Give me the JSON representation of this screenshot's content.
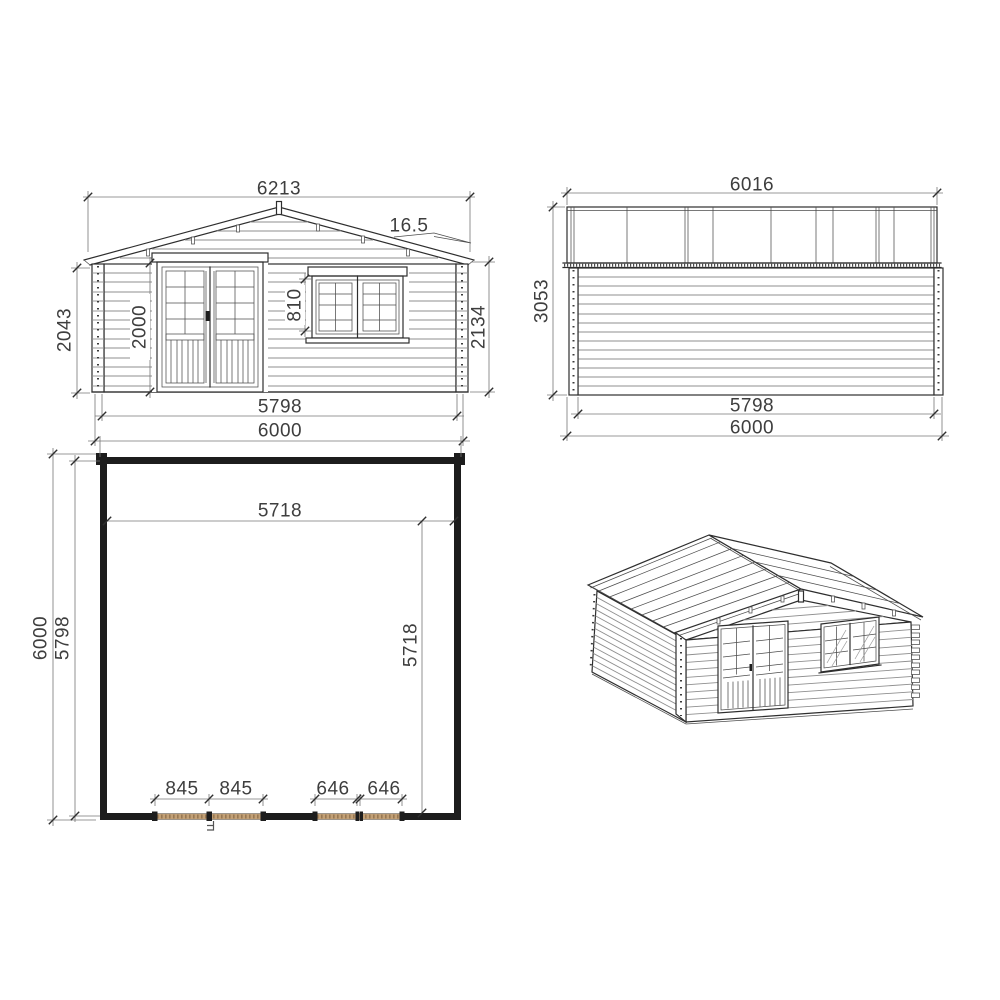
{
  "front_elevation": {
    "roof_width": "6213",
    "roof_angle": "16.5",
    "left_height": "2043",
    "door_height": "2000",
    "window_height": "810",
    "right_height": "2134",
    "wall_width": "5798",
    "overall_width": "6000"
  },
  "side_elevation": {
    "roof_depth": "6016",
    "total_height": "3053",
    "wall_depth": "5798",
    "overall_depth": "6000"
  },
  "floor_plan": {
    "interior_width": "5718",
    "interior_depth": "5718",
    "overall_depth": "6000",
    "wall_depth": "5798",
    "door_half_left": "845",
    "door_half_right": "845",
    "window_half_left": "646",
    "window_half_right": "646"
  },
  "colors": {
    "line": "#2e2e2e",
    "dim_line": "#777777",
    "text": "#3e3e3e",
    "opening_hatch": "#c2a076",
    "background": "#ffffff"
  }
}
